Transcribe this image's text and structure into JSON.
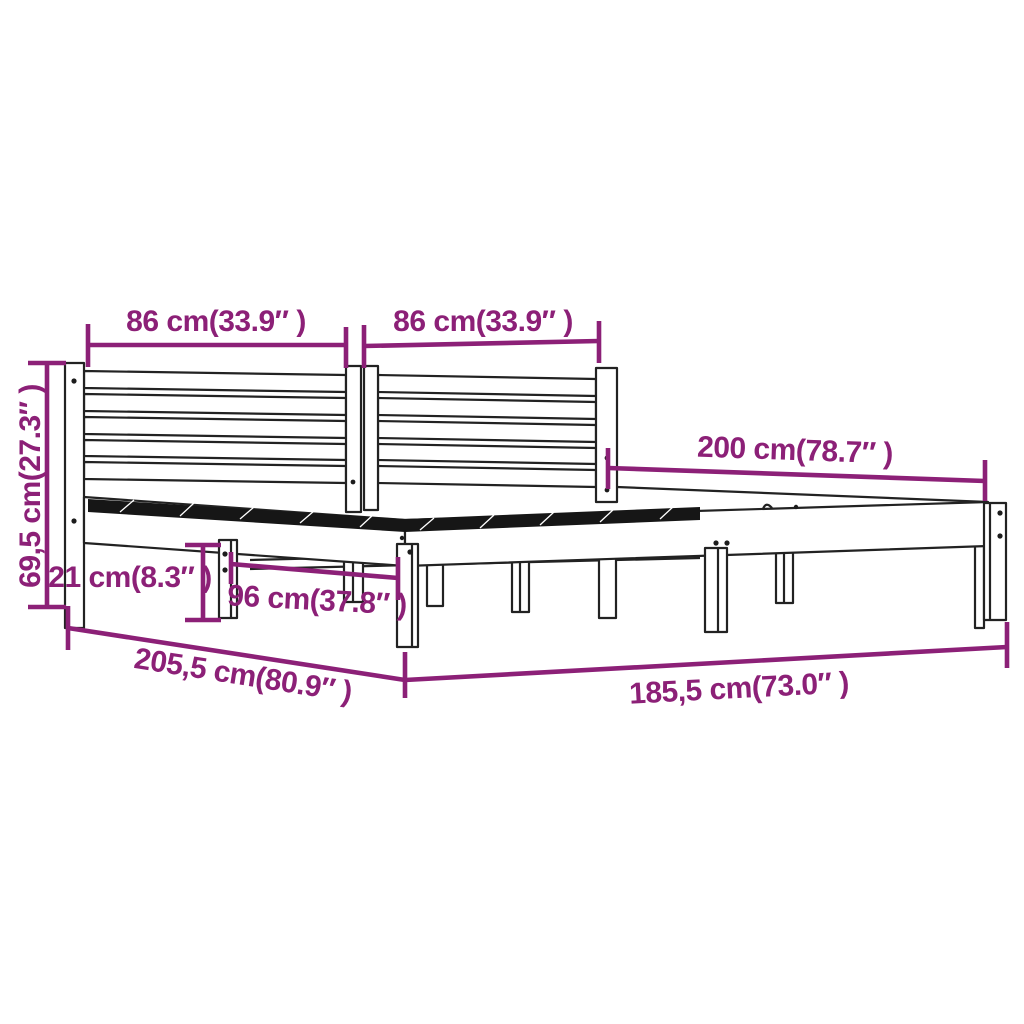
{
  "diagram": {
    "type": "product-dimension-drawing",
    "subject": "wooden bed frame with slatted double headboard",
    "colors": {
      "dimension_accent": "#8C2077",
      "drawing_line": "#222222",
      "background": "#ffffff",
      "slat_hatch": "#161616"
    },
    "dimensions": [
      {
        "id": "headboard-left-width",
        "label": "86 cm(33.9″ )"
      },
      {
        "id": "headboard-right-width",
        "label": "86 cm(33.9″ )"
      },
      {
        "id": "bed-length",
        "label": "200 cm(78.7″ )"
      },
      {
        "id": "headboard-height",
        "label": "69,5 cm(27.3″ )"
      },
      {
        "id": "leg-clearance-height",
        "label": "21 cm(8.3″ )"
      },
      {
        "id": "leg-spacing",
        "label": "96 cm(37.8″ )"
      },
      {
        "id": "total-length",
        "label": "205,5 cm(80.9″ )"
      },
      {
        "id": "total-width",
        "label": "185,5 cm(73.0″ )"
      }
    ]
  }
}
